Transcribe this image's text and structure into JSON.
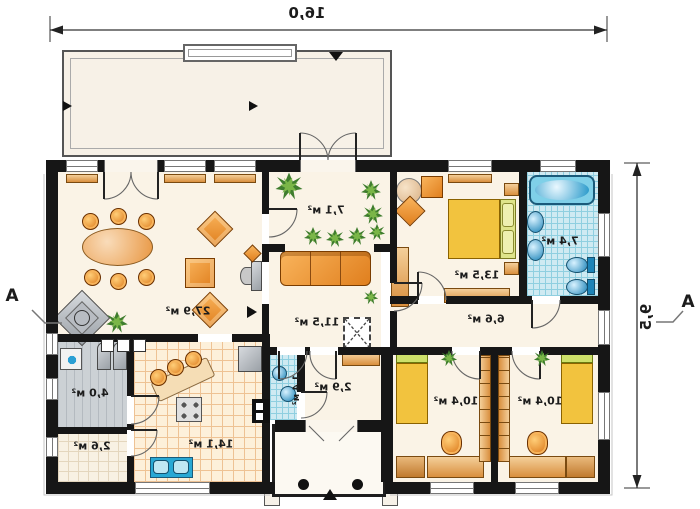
{
  "plan": {
    "dimensions": {
      "width": "16,0",
      "height": "9,5"
    },
    "section": {
      "left": "A",
      "right": "A"
    },
    "rooms": [
      {
        "name": "living-room",
        "area": "27,9 м²"
      },
      {
        "name": "winter-garden",
        "area": "7,1 м²"
      },
      {
        "name": "corridor",
        "area": "11,5 м²"
      },
      {
        "name": "bedroom-main",
        "area": "13,5 м²"
      },
      {
        "name": "bathroom",
        "area": "7,4 м²"
      },
      {
        "name": "hall",
        "area": "6,6 м²"
      },
      {
        "name": "child-bedroom-left",
        "area": "10,4 м²"
      },
      {
        "name": "child-bedroom-right",
        "area": "10,4 м²"
      },
      {
        "name": "kitchen",
        "area": "14,1 м²"
      },
      {
        "name": "utility-room",
        "area": "4,0 м²"
      },
      {
        "name": "pantry",
        "area": "2,6 м²"
      },
      {
        "name": "wc",
        "area": "1,4 м²"
      },
      {
        "name": "entry-hall",
        "area": "2,9 м²"
      }
    ],
    "colors": {
      "wall": "#161616",
      "floor": "#faf3e6",
      "furniture_orange": "#e8872a",
      "wood": "#e9b06c",
      "tile_blue": "#cfeaf2",
      "fixture_blue": "#2b9fd4",
      "bed_yellow": "#f2c23e",
      "plant_green": "#3f7d2e"
    }
  }
}
